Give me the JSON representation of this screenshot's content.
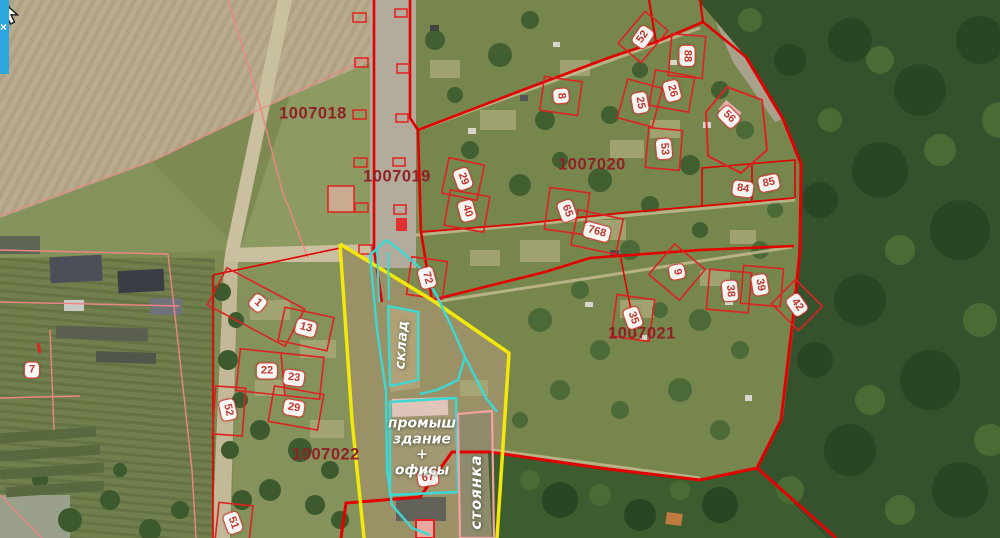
{
  "app": {
    "panel_close_label": "×"
  },
  "map": {
    "quarters": [
      {
        "text": "1007018",
        "x": 313,
        "y": 114
      },
      {
        "text": "1007019",
        "x": 397,
        "y": 177
      },
      {
        "text": "1007020",
        "x": 592,
        "y": 165
      },
      {
        "text": "1007021",
        "x": 642,
        "y": 334
      },
      {
        "text": "1007022",
        "x": 326,
        "y": 455
      }
    ],
    "parcels": [
      {
        "text": "52",
        "x": 643,
        "y": 37,
        "rot": -55
      },
      {
        "text": "88",
        "x": 687,
        "y": 56,
        "rot": 90
      },
      {
        "text": "8",
        "x": 561,
        "y": 96,
        "rot": 85
      },
      {
        "text": "26",
        "x": 672,
        "y": 91,
        "rot": 75
      },
      {
        "text": "25",
        "x": 640,
        "y": 103,
        "rot": 80
      },
      {
        "text": "56",
        "x": 729,
        "y": 117,
        "rot": 45
      },
      {
        "text": "53",
        "x": 664,
        "y": 149,
        "rot": 85
      },
      {
        "text": "29",
        "x": 463,
        "y": 179,
        "rot": 70
      },
      {
        "text": "40",
        "x": 467,
        "y": 211,
        "rot": 75
      },
      {
        "text": "65",
        "x": 567,
        "y": 211,
        "rot": 70
      },
      {
        "text": "768",
        "x": 597,
        "y": 232,
        "rot": 15
      },
      {
        "text": "84",
        "x": 743,
        "y": 189,
        "rot": 8
      },
      {
        "text": "85",
        "x": 769,
        "y": 183,
        "rot": -12
      },
      {
        "text": "72",
        "x": 427,
        "y": 278,
        "rot": 75
      },
      {
        "text": "9",
        "x": 677,
        "y": 272,
        "rot": 80
      },
      {
        "text": "38",
        "x": 730,
        "y": 291,
        "rot": 85
      },
      {
        "text": "39",
        "x": 760,
        "y": 285,
        "rot": 80
      },
      {
        "text": "42",
        "x": 797,
        "y": 305,
        "rot": 55
      },
      {
        "text": "35",
        "x": 633,
        "y": 318,
        "rot": 70
      },
      {
        "text": "1",
        "x": 258,
        "y": 303,
        "rot": 40
      },
      {
        "text": "13",
        "x": 306,
        "y": 328,
        "rot": 15
      },
      {
        "text": "22",
        "x": 267,
        "y": 371,
        "rot": 0
      },
      {
        "text": "23",
        "x": 294,
        "y": 378,
        "rot": 8
      },
      {
        "text": "29",
        "x": 294,
        "y": 408,
        "rot": 10
      },
      {
        "text": "52",
        "x": 228,
        "y": 410,
        "rot": 78
      },
      {
        "text": "7",
        "x": 32,
        "y": 370,
        "rot": 0
      },
      {
        "text": "51",
        "x": 233,
        "y": 523,
        "rot": 70
      },
      {
        "text": "67",
        "x": 428,
        "y": 478,
        "rot": -8
      }
    ],
    "zone_labels": {
      "sklad": "склад",
      "building_line1": "промыш",
      "building_line2": "здание",
      "building_line3": "+",
      "building_line4": "офисы",
      "stoyanka": "стоянка"
    },
    "colors": {
      "cadastral_red": "#e20000",
      "cadastral_pink": "#ee8585",
      "quarter_label": "#8f2127",
      "badge_border": "#d5413a",
      "badge_text": "#c23530",
      "selection_yellow": "#f3e80c",
      "zone_cyan": "#3ed8d4",
      "stoyanka_pink": "#f2a0a0",
      "zone_label_text": "#ffffff",
      "panel_button_blue": "#2ba6df"
    }
  }
}
